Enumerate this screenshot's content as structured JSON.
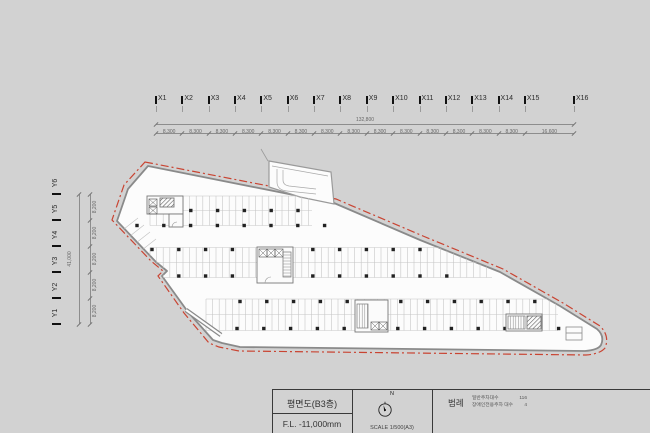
{
  "colors": {
    "background": "#d2d2d2",
    "paper": "#fcfcfc",
    "boundary_red": "#c94432",
    "wall": "#8a8a8a",
    "ink": "#222222",
    "dim": "#666666"
  },
  "grid": {
    "x_labels": [
      "X1",
      "X2",
      "X3",
      "X4",
      "X5",
      "X6",
      "X7",
      "X8",
      "X9",
      "X10",
      "X11",
      "X12",
      "X13",
      "X14",
      "X15",
      "X16"
    ],
    "x_total": "132,800",
    "x_segments": [
      "8,300",
      "8,300",
      "8,300",
      "8,300",
      "8,300",
      "8,300",
      "8,300",
      "8,300",
      "8,300",
      "8,300",
      "8,300",
      "8,300",
      "8,300",
      "8,300",
      "16,600"
    ],
    "y_labels": [
      "Y1",
      "Y2",
      "Y3",
      "Y4",
      "Y5",
      "Y6"
    ],
    "y_total": "41,000",
    "y_segments": [
      "8,200",
      "8,200",
      "8,200",
      "8,200",
      "8,200"
    ]
  },
  "titleblock": {
    "drawing_title": "평면도(B3층)",
    "floor_level": "F.L. -11,000mm",
    "north_label": "N",
    "scale_label": "SCALE 1/500(A3)",
    "legend_title": "범례",
    "legend_items": [
      {
        "label": "일반주차대수",
        "value": "116"
      },
      {
        "label": "장애인전용주차 대수",
        "value": "4"
      }
    ]
  }
}
